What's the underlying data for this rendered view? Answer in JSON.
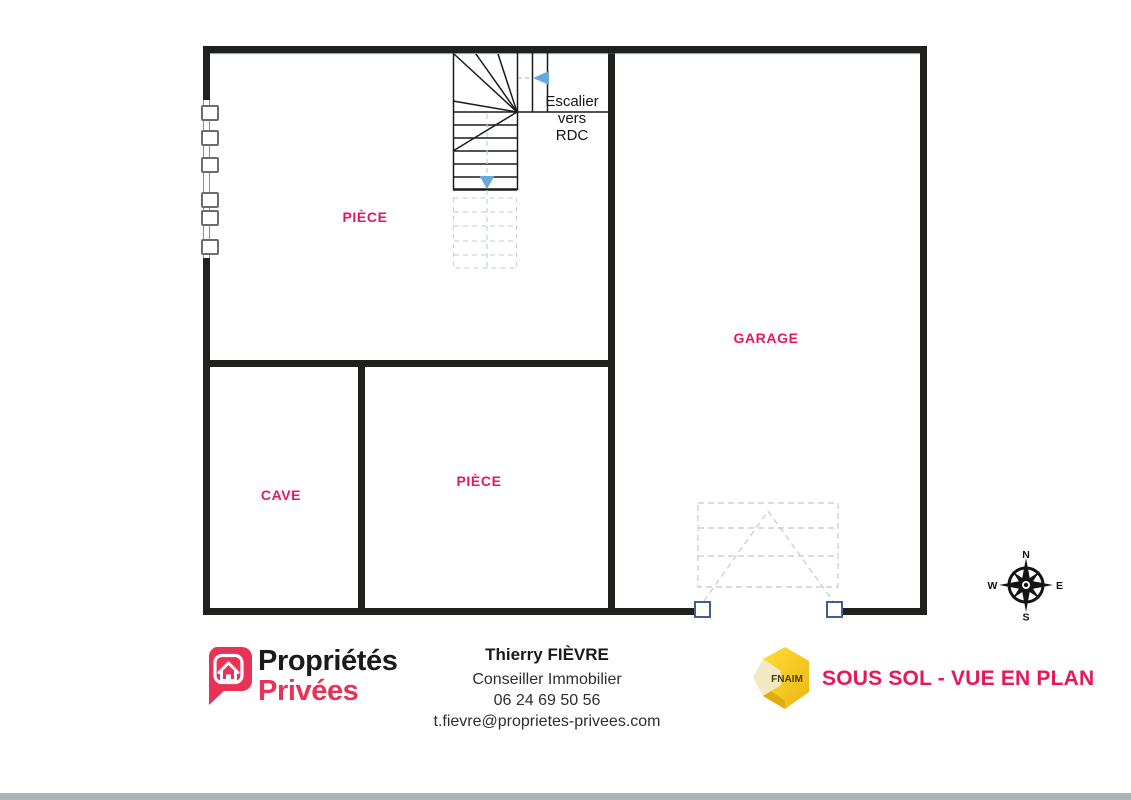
{
  "plan": {
    "rooms": [
      {
        "label": "PIÈCE"
      },
      {
        "label": "GARAGE"
      },
      {
        "label": "CAVE"
      },
      {
        "label": "PIÈCE"
      }
    ],
    "stair_label": {
      "line1": "Escalier",
      "line2": "vers",
      "line3": "RDC"
    },
    "compass": {
      "n": "N",
      "e": "E",
      "s": "S",
      "w": "W"
    }
  },
  "footer": {
    "brand": {
      "word1": "Propriétés",
      "word2": "Privées"
    },
    "agent": {
      "name": "Thierry FIÈVRE",
      "title": "Conseiller Immobilier",
      "phone": "06 24 69 50 56",
      "email": "t.fievre@proprietes-privees.com"
    },
    "fnaim_label": "FNAIM",
    "plan_title": "SOUS SOL - VUE EN PLAN"
  },
  "colors": {
    "accent_pink": "#e8175a",
    "brand_pink": "#e93257",
    "wall": "#1e211e",
    "arrow_blue": "#66a9db",
    "fnaim_yellow": "#ffd21e",
    "ghost_gray": "#ccd1d6"
  }
}
